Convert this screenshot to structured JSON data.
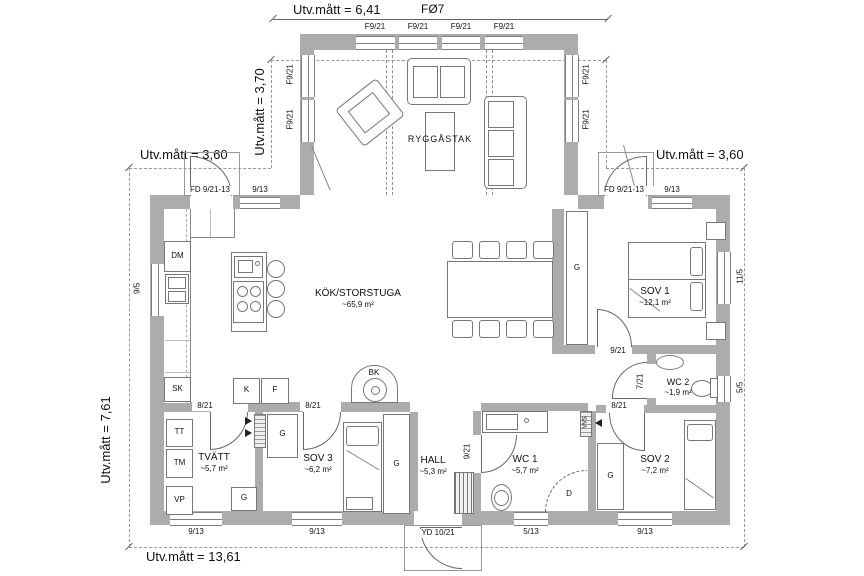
{
  "dims": {
    "top": "Utv.mått = 6,41",
    "fo7": "FØ7",
    "top_section": "Utv.mått = 3,70",
    "left_wing": "Utv.mått = 3,60",
    "right_wing": "Utv.mått = 3,60",
    "side": "Utv.mått = 7,61",
    "bottom": "Utv.mått = 13,61"
  },
  "rooms": {
    "livingroom": {
      "name": "RYGGÅSTAK"
    },
    "kitchen": {
      "name": "KÖK/STORSTUGA",
      "area": "~65,9 m²"
    },
    "sov1": {
      "name": "SOV 1",
      "area": "~12,1 m²"
    },
    "wc2": {
      "name": "WC 2",
      "area": "~1,9 m²"
    },
    "sov2": {
      "name": "SOV 2",
      "area": "~7,2 m²"
    },
    "wc1": {
      "name": "WC 1",
      "area": "~5,7 m²"
    },
    "hall": {
      "name": "HALL",
      "area": "~5,3 m²"
    },
    "sov3": {
      "name": "SOV 3",
      "area": "~6,2 m²"
    },
    "tvatt": {
      "name": "TVÄTT",
      "area": "~5,7 m²"
    }
  },
  "openings": {
    "f921": "F9/21",
    "w913": "9/13",
    "w95": "9/5",
    "w115": "11/5",
    "w55": "5/5",
    "w513": "5/13",
    "fd": "FD 9/21-13",
    "yd": "YD 10/21",
    "d921": "9/21",
    "d821": "8/21",
    "d721": "7/21"
  },
  "fixtures": {
    "dm": "DM",
    "sk": "SK",
    "tt": "TT",
    "tm": "TM",
    "vp": "VP",
    "k": "K",
    "f": "F",
    "g": "G",
    "bk": "BK",
    "d": "D",
    "vvs": "VVS"
  }
}
